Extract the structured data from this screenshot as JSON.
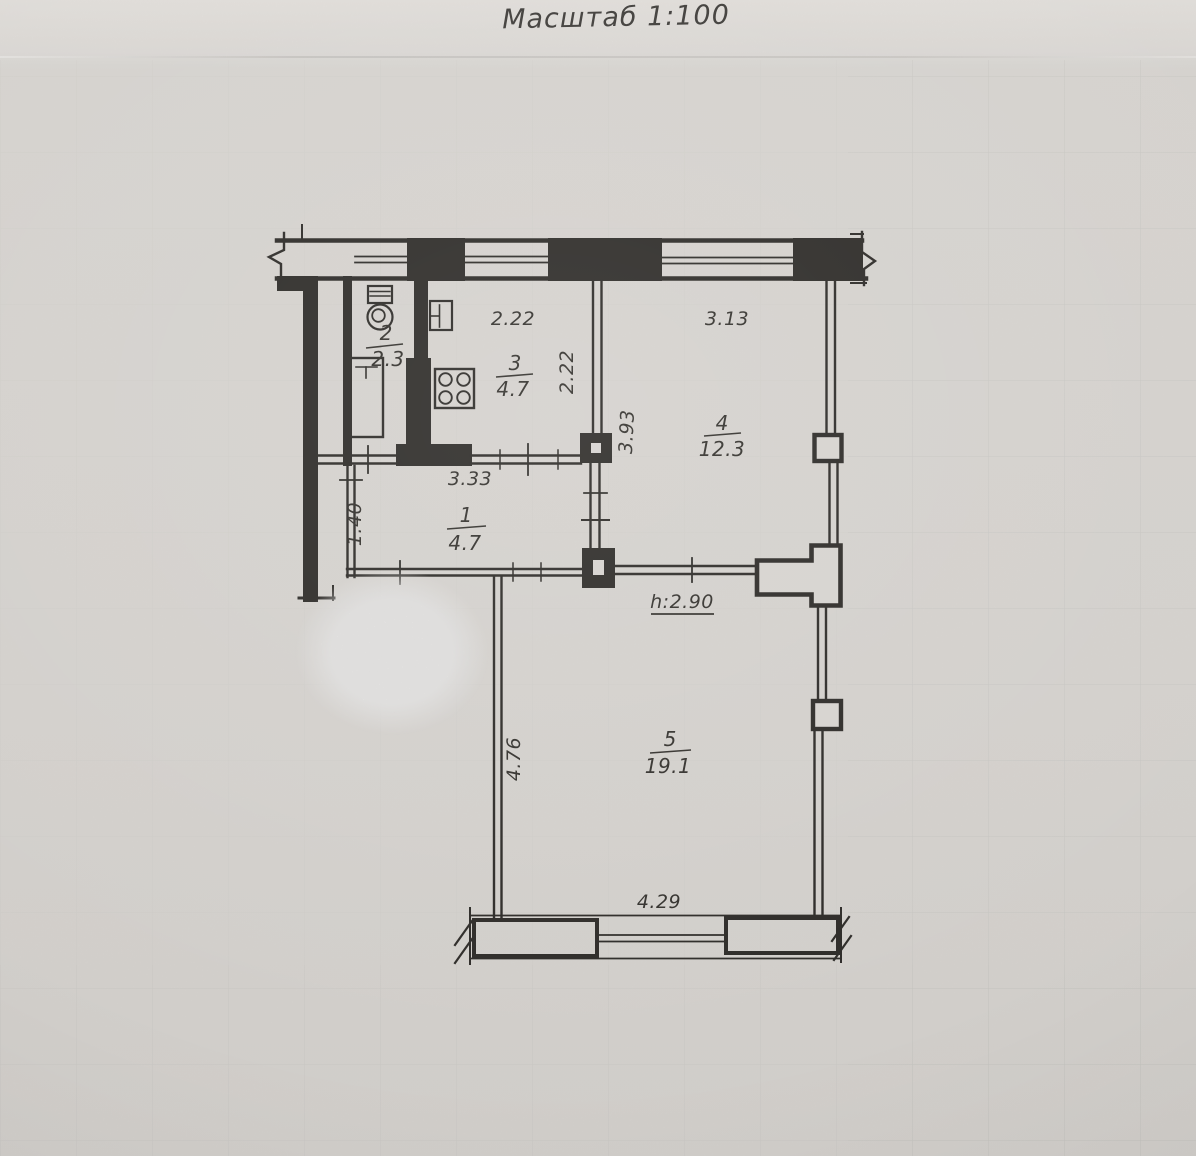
{
  "header": {
    "title": "Масштаб 1:100"
  },
  "plan": {
    "rooms": [
      {
        "number": "1",
        "area": "4.7"
      },
      {
        "number": "2",
        "area": "2.3"
      },
      {
        "number": "3",
        "area": "4.7"
      },
      {
        "number": "4",
        "area": "12.3"
      },
      {
        "number": "5",
        "area": "19.1"
      }
    ],
    "dimensions": {
      "top_window_left": "2.22",
      "top_window_right": "3.13",
      "kitchen_depth": "2.22",
      "room4_depth": "3.93",
      "hallway_width": "3.33",
      "hallway_depth": "1.40",
      "ceiling_height": "h:2.90",
      "room5_depth": "4.76",
      "room5_width": "4.29"
    },
    "fixtures": [
      "toilet-icon",
      "bathtub-icon",
      "sink-icon",
      "stove-icon"
    ],
    "colors": {
      "ink": "#2e2c29",
      "paper": "#d6d3cf"
    }
  }
}
